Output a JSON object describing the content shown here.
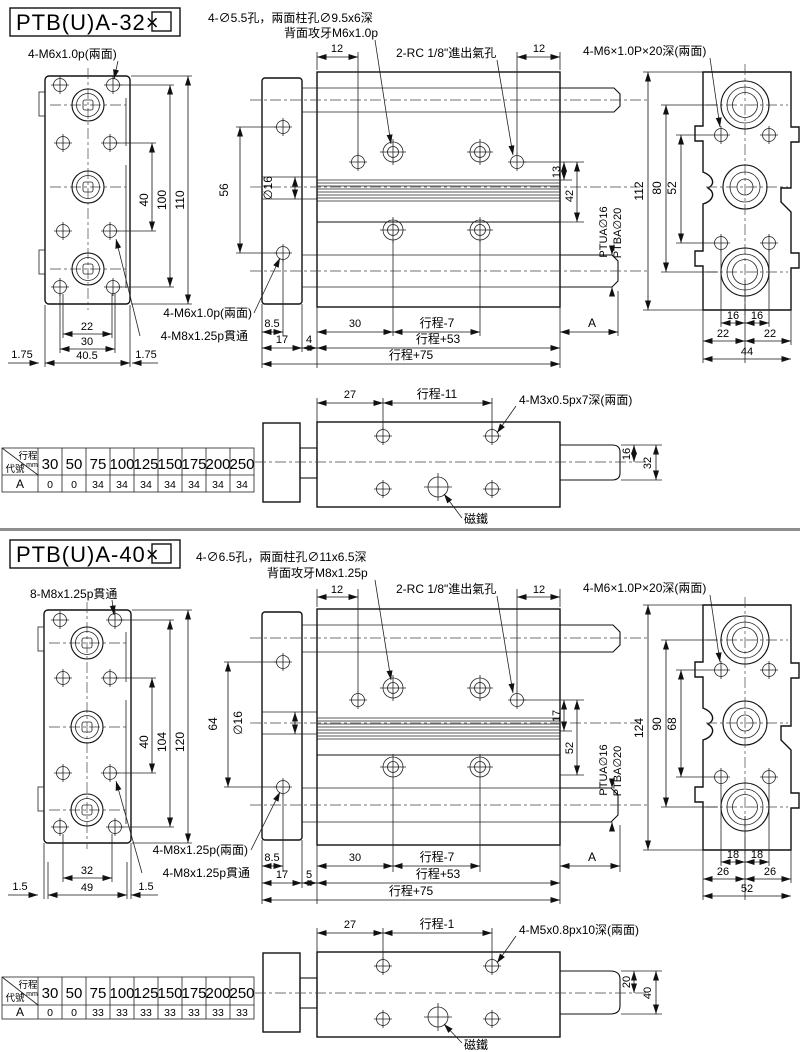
{
  "sections": [
    {
      "title": "PTB(U)A-32×",
      "notes": {
        "drill_note1": "4-∅5.5孔，兩面柱孔∅9.5x6深",
        "drill_note2": "背面攻牙M6x1.0p",
        "port": "2-RC 1/8\"進出氣孔",
        "end_thread": "4-M6×1.0P×20深(兩面)",
        "front_top": "4-M6x1.0p(兩面)",
        "plate_thread": "4-M6x1.0p(兩面)",
        "through_thread": "4-M8x1.25p貫通",
        "bottom_thread": "4-M3x0.5px7深(兩面)",
        "magnet": "磁鐵",
        "rod_top": "PTUA∅16",
        "rod_bottom": "PTBA∅20"
      },
      "front_dims": {
        "v1": "40",
        "v2": "100",
        "v3": "110",
        "b1": "22",
        "b2": "30",
        "b3": "40.5",
        "s_left": "1.75",
        "s_right": "1.75"
      },
      "side_dims": {
        "t_left": "12",
        "t_right": "12",
        "d1": "13",
        "d2": "42",
        "span": "56",
        "rod_dia": "∅16",
        "r1a": "8.5",
        "r1b": "30",
        "r1c": "行程-7",
        "r1d": "A",
        "r2a": "17",
        "r2b": "4",
        "r2c": "行程+53",
        "r3": "行程+75"
      },
      "end_dims": {
        "height": "112",
        "c1": "80",
        "c2": "52",
        "b1l": "16",
        "b1r": "16",
        "b2l": "22",
        "b2r": "22",
        "b3": "44"
      },
      "bottom_view": {
        "d1": "27",
        "d2": "行程-11",
        "rod_half": "16",
        "rod_full": "32"
      },
      "table": {
        "diag_top": "行程",
        "diag_unit": "mm",
        "diag_bottom": "代號",
        "columns": [
          "30",
          "50",
          "75",
          "100",
          "125",
          "150",
          "175",
          "200",
          "250"
        ],
        "row_label": "A",
        "values": [
          "0",
          "0",
          "34",
          "34",
          "34",
          "34",
          "34",
          "34",
          "34"
        ]
      }
    },
    {
      "title": "PTB(U)A-40×",
      "notes": {
        "drill_note1": "4-∅6.5孔，兩面柱孔∅11x6.5深",
        "drill_note2": "背面攻牙M8x1.25p",
        "port": "2-RC 1/8\"進出氣孔",
        "end_thread": "4-M6×1.0P×20深(兩面)",
        "front_top": "8-M8x1.25p貫通",
        "plate_thread": "4-M8x1.25p(兩面)",
        "through_thread": "4-M8x1.25p貫通",
        "bottom_thread": "4-M5x0.8px10深(兩面)",
        "magnet": "磁鐵",
        "rod_top": "PTUA∅16",
        "rod_bottom": "PTBA∅20"
      },
      "front_dims": {
        "v1": "40",
        "v2": "104",
        "v3": "120",
        "b1": "32",
        "b2": "49",
        "b3": "",
        "s_left": "1.5",
        "s_right": "1.5"
      },
      "side_dims": {
        "t_left": "12",
        "t_right": "12",
        "d1": "17",
        "d2": "52",
        "span": "64",
        "rod_dia": "∅16",
        "r1a": "8.5",
        "r1b": "30",
        "r1c": "行程-7",
        "r1d": "A",
        "r2a": "17",
        "r2b": "5",
        "r2c": "行程+53",
        "r3": "行程+75"
      },
      "end_dims": {
        "height": "124",
        "c1": "90",
        "c2": "68",
        "b1l": "18",
        "b1r": "18",
        "b2l": "26",
        "b2r": "26",
        "b3": "52"
      },
      "bottom_view": {
        "d1": "27",
        "d2": "行程-1",
        "rod_half": "20",
        "rod_full": "40"
      },
      "table": {
        "diag_top": "行程",
        "diag_unit": "mm",
        "diag_bottom": "代號",
        "columns": [
          "30",
          "50",
          "75",
          "100",
          "125",
          "150",
          "175",
          "200",
          "250"
        ],
        "row_label": "A",
        "values": [
          "0",
          "0",
          "33",
          "33",
          "33",
          "33",
          "33",
          "33",
          "33"
        ]
      }
    }
  ]
}
